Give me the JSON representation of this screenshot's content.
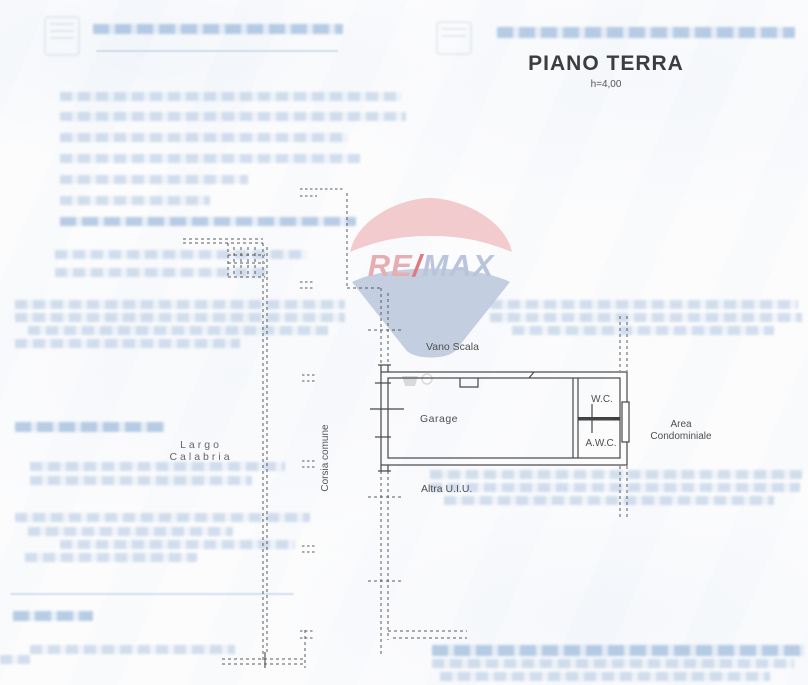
{
  "document": {
    "title": "PIANO TERRA",
    "height_note": "h=4,00"
  },
  "watermark": {
    "brand": "RE/MAX",
    "part_re": "RE",
    "part_slash": "/",
    "part_max": "MAX",
    "colors": {
      "balloon_top": "#f2c6c9",
      "balloon_bottom": "#bfcadf",
      "text_re": "#e5a5ab",
      "text_slash": "#dd6a73",
      "text_max": "#b3c0d8"
    }
  },
  "plan": {
    "labels": {
      "vano_scala": "Vano Scala",
      "garage": "Garage",
      "wc": "W.C.",
      "awc": "A.W.C.",
      "area_line1": "Area",
      "area_line2": "Condominiale",
      "street_line1": "Largo",
      "street_line2": "Calabria",
      "corsia": "Corsia comune",
      "altra_uiu": "Altra U.I.U."
    }
  },
  "faint_text": {
    "note": "washed-out illegible blue document text from the scanned page",
    "lines": [
      {
        "x": 93,
        "y": 24,
        "w": 250,
        "h": 10,
        "s": 1
      },
      {
        "x": 96,
        "y": 50,
        "w": 242,
        "h": 2,
        "r": 1
      },
      {
        "x": 497,
        "y": 27,
        "w": 298,
        "h": 11,
        "s": 1
      },
      {
        "x": 60,
        "y": 92,
        "w": 342,
        "h": 9
      },
      {
        "x": 60,
        "y": 112,
        "w": 346,
        "h": 9
      },
      {
        "x": 60,
        "y": 133,
        "w": 288,
        "h": 9
      },
      {
        "x": 60,
        "y": 154,
        "w": 300,
        "h": 9
      },
      {
        "x": 60,
        "y": 175,
        "w": 188,
        "h": 9
      },
      {
        "x": 60,
        "y": 196,
        "w": 150,
        "h": 9
      },
      {
        "x": 60,
        "y": 217,
        "w": 296,
        "h": 9,
        "s": 1
      },
      {
        "x": 55,
        "y": 250,
        "w": 252,
        "h": 9
      },
      {
        "x": 55,
        "y": 268,
        "w": 212,
        "h": 9
      },
      {
        "x": 15,
        "y": 300,
        "w": 330,
        "h": 9
      },
      {
        "x": 490,
        "y": 300,
        "w": 308,
        "h": 9
      },
      {
        "x": 15,
        "y": 313,
        "w": 330,
        "h": 9
      },
      {
        "x": 490,
        "y": 313,
        "w": 312,
        "h": 9
      },
      {
        "x": 28,
        "y": 326,
        "w": 300,
        "h": 9
      },
      {
        "x": 512,
        "y": 326,
        "w": 262,
        "h": 9
      },
      {
        "x": 15,
        "y": 339,
        "w": 225,
        "h": 9
      },
      {
        "x": 15,
        "y": 422,
        "w": 150,
        "h": 10,
        "s": 1
      },
      {
        "x": 30,
        "y": 462,
        "w": 255,
        "h": 9
      },
      {
        "x": 30,
        "y": 476,
        "w": 222,
        "h": 9
      },
      {
        "x": 15,
        "y": 513,
        "w": 295,
        "h": 9
      },
      {
        "x": 28,
        "y": 527,
        "w": 205,
        "h": 9
      },
      {
        "x": 60,
        "y": 540,
        "w": 235,
        "h": 9
      },
      {
        "x": 25,
        "y": 553,
        "w": 172,
        "h": 9
      },
      {
        "x": 430,
        "y": 470,
        "w": 372,
        "h": 9
      },
      {
        "x": 430,
        "y": 483,
        "w": 370,
        "h": 9
      },
      {
        "x": 444,
        "y": 496,
        "w": 330,
        "h": 9
      },
      {
        "x": 10,
        "y": 593,
        "w": 284,
        "h": 2,
        "r": 1
      },
      {
        "x": 13,
        "y": 611,
        "w": 80,
        "h": 10,
        "s": 1
      },
      {
        "x": 30,
        "y": 645,
        "w": 205,
        "h": 9
      },
      {
        "x": 0,
        "y": 655,
        "w": 30,
        "h": 9
      },
      {
        "x": 432,
        "y": 645,
        "w": 372,
        "h": 11,
        "s": 1
      },
      {
        "x": 432,
        "y": 659,
        "w": 362,
        "h": 9
      },
      {
        "x": 440,
        "y": 672,
        "w": 330,
        "h": 9
      }
    ]
  }
}
